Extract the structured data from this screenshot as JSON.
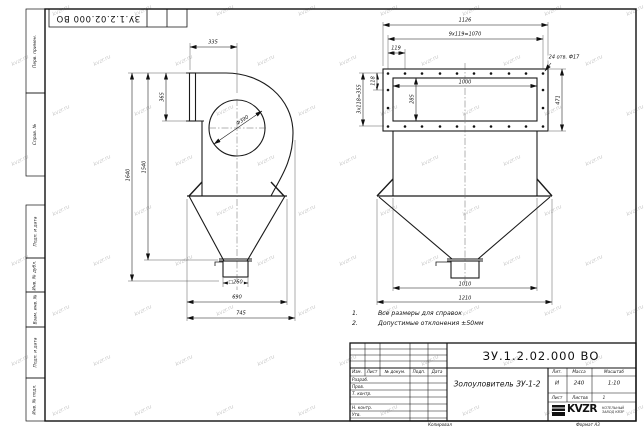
{
  "page": {
    "watermark": "kvzr.ru",
    "top_stamp_number": "ЗУ.1.2.02.000 ВО",
    "copied_label": "Копировал",
    "format_label": "Формат А3"
  },
  "sidebar": {
    "labels": [
      "Перв. примен.",
      "Справ. №",
      "Подп. и дата",
      "Инв. № дубл.",
      "Взам. инв. №",
      "Подп. и дата",
      "Инв. № подл."
    ]
  },
  "notes": {
    "items": [
      {
        "num": "1.",
        "text": "Все размеры для справок"
      },
      {
        "num": "2.",
        "text": "Допустимые отклонения ±50мм"
      }
    ]
  },
  "side_view_dims": {
    "d335": "335",
    "d365": "365",
    "d390": "Ф390",
    "d1640": "1640",
    "d1540": "1540",
    "d260": "□260",
    "d690": "690",
    "d745": "745"
  },
  "front_view_dims": {
    "d1126": "1126",
    "bolt_h": "9x119=1070",
    "d119": "119",
    "holes": "24 отв. Ф17",
    "d1000": "1000",
    "d285": "285",
    "d118": "118",
    "bolt_v": "3x118=355",
    "d471": "471",
    "d1010": "1010",
    "d1210": "1210"
  },
  "title_block": {
    "doc_number": "ЗУ.1.2.02.000 ВО",
    "part_name": "Золоуловитель ЗУ-1-2",
    "header_cols": [
      "Изм.",
      "Лист",
      "№ докум.",
      "Подп.",
      "Дата"
    ],
    "sign_rows": [
      "Разраб.",
      "Пров.",
      "Т. контр.",
      "Н. контр.",
      "Утв."
    ],
    "lit_label": "Лит.",
    "mass_label": "Масса",
    "scale_label": "Масштаб",
    "lit_value": "И",
    "mass_value": "240",
    "scale_value": "1:10",
    "sheet_label": "Лист",
    "sheets_label": "Листов",
    "sheets_value": "1",
    "company": "KVZR",
    "company_sub1": "КОТЕЛЬНЫЙ",
    "company_sub2": "ЗАВОД КВЗР",
    "line_color": "#111111"
  }
}
